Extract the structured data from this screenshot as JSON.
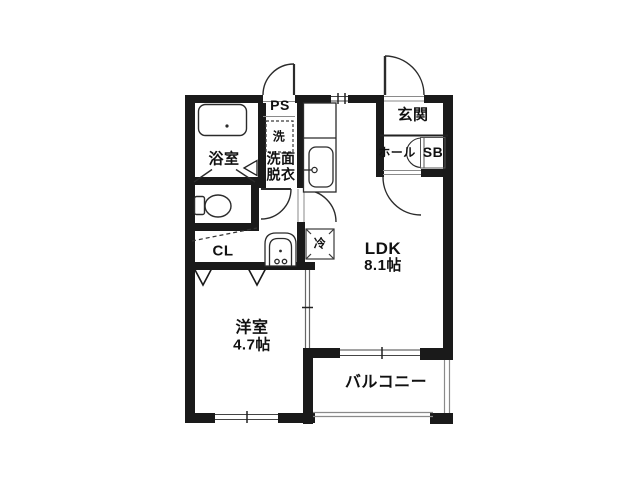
{
  "floorplan": {
    "rooms": {
      "ldk": {
        "label": "LDK",
        "size": "8.1帖"
      },
      "western_room": {
        "label": "洋室",
        "size": "4.7帖"
      },
      "balcony": {
        "label": "バルコニー"
      },
      "bathroom": {
        "label": "浴室"
      },
      "washroom": {
        "line1": "洗面",
        "line2": "脱衣"
      },
      "entrance": {
        "label": "玄関"
      },
      "hall": {
        "label": "ホール"
      },
      "shoe_box": {
        "label": "SB"
      },
      "pipe_space": {
        "label": "PS"
      },
      "closet": {
        "label": "CL"
      },
      "washer": {
        "label": "洗"
      },
      "refrigerator": {
        "label": "冷"
      }
    },
    "colors": {
      "wall": "#1a1a1a",
      "fixture": "#2b2b2b",
      "thin_line": "#777777",
      "background": "#ffffff",
      "text": "#111111"
    }
  }
}
